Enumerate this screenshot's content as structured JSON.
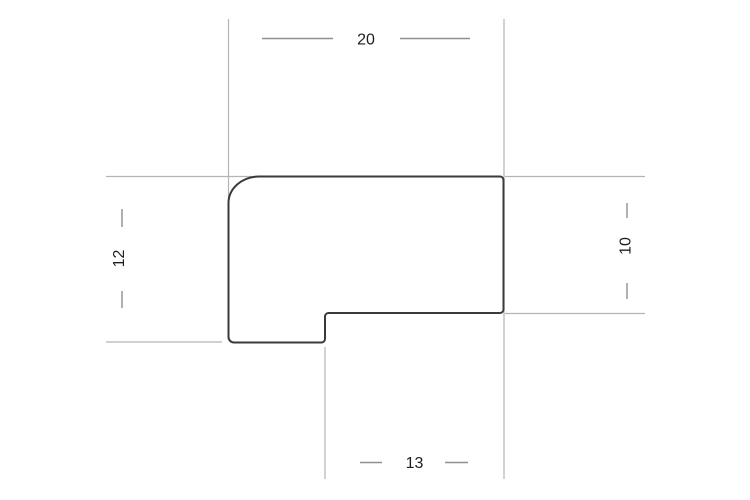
{
  "drawing": {
    "type": "technical-profile-cross-section",
    "background_color": "#ffffff",
    "outline_color": "#3a3a3a",
    "extension_line_color": "#b4b4b4",
    "dimension_line_color": "#8f8f8f",
    "label_color": "#1e1e1e",
    "dimensions": {
      "top": "20",
      "left": "12",
      "right": "10",
      "bottom": "13"
    }
  }
}
